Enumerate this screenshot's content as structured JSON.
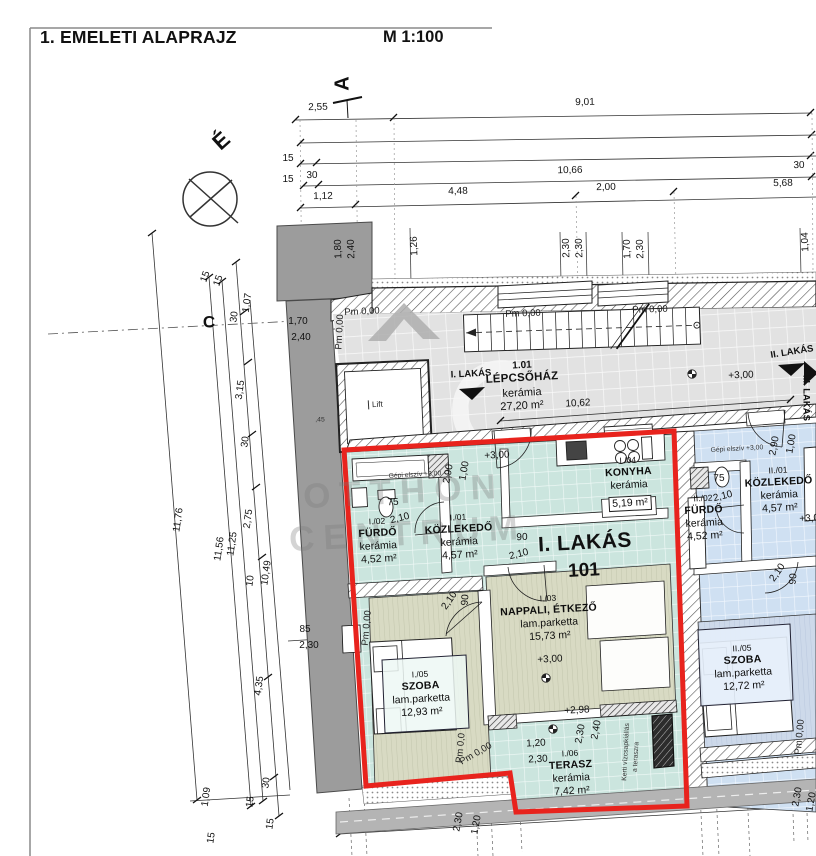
{
  "header": {
    "title": "1. EMELETI ALAPRAJZ",
    "scale": "M 1:100"
  },
  "markers": {
    "north": "É",
    "section_a": "A",
    "apt1": "I. LAKÁS",
    "apt2": "II. LAKÁS",
    "apt3": "III. LAKÁS"
  },
  "stairwell": {
    "id": "1.01",
    "name": "LÉPCSŐHÁZ",
    "floor": "kerámia",
    "area": "27,20 m²",
    "lift": "Lift"
  },
  "watermark": {
    "line1": "OTTHON",
    "line2": "CENTRUM"
  },
  "colors": {
    "accent_red": "#E8231D",
    "apt1_teal": "#CBE5DE",
    "apt2_blue": "#CFE0F2",
    "mass_gray": "#9C9C9C"
  },
  "apartments": [
    {
      "id": "I. LAKÁS",
      "number": "101",
      "rooms": [
        {
          "id": "I./02",
          "name": "FÜRDŐ",
          "floor": "kerámia",
          "area": "4,52 m²",
          "cx": 378,
          "ty": 516
        },
        {
          "id": "I./01",
          "name": "KÖZLEKEDŐ",
          "floor": "kerámia",
          "area": "4,57 m²",
          "cx": 459,
          "ty": 512
        },
        {
          "id": "I./04",
          "name": "KONYHA",
          "floor": "kerámia",
          "area": "5,19 m²",
          "cx": 629,
          "ty": 455,
          "boxed": true
        },
        {
          "id": "I./03",
          "name": "NAPPALI, ÉTKEZŐ",
          "floor": "lam.parketta",
          "area": "15,73 m²",
          "cx": 549,
          "ty": 593
        },
        {
          "id": "I./05",
          "name": "SZOBA",
          "floor": "lam.parketta",
          "area": "12,93 m²",
          "cx": 421,
          "ty": 669
        },
        {
          "id": "I./06",
          "name": "TERASZ",
          "floor": "kerámia",
          "area": "7,42 m²",
          "cx": 571,
          "ty": 748
        }
      ]
    },
    {
      "id": "II. LAKÁS",
      "number": "",
      "rooms": [
        {
          "id": "II./02",
          "name": "FÜRDŐ",
          "floor": "kerámia",
          "area": "4,52 m²",
          "cx": 704,
          "ty": 493
        },
        {
          "id": "II./01",
          "name": "KÖZLEKEDŐ",
          "floor": "kerámia",
          "area": "4,57 m²",
          "cx": 779,
          "ty": 465
        },
        {
          "id": "II./05",
          "name": "SZOBA",
          "floor": "lam.parketta",
          "area": "12,72 m²",
          "cx": 743,
          "ty": 643
        }
      ]
    }
  ],
  "annotations": [
    {
      "t": "2,55",
      "x": 318,
      "y": 108,
      "r": -1
    },
    {
      "t": "9,01",
      "x": 585,
      "y": 103,
      "r": -1
    },
    {
      "t": "15",
      "x": 288,
      "y": 159
    },
    {
      "t": "15",
      "x": 288,
      "y": 180
    },
    {
      "t": "30",
      "x": 312,
      "y": 176,
      "r": -1
    },
    {
      "t": "10,66",
      "x": 570,
      "y": 171,
      "r": -1
    },
    {
      "t": "30",
      "x": 799,
      "y": 166,
      "r": -1
    },
    {
      "t": "1,12",
      "x": 323,
      "y": 197,
      "r": -1
    },
    {
      "t": "4,48",
      "x": 458,
      "y": 192,
      "r": -1
    },
    {
      "t": "2,00",
      "x": 606,
      "y": 188,
      "r": -1
    },
    {
      "t": "5,68",
      "x": 783,
      "y": 184,
      "r": -1
    },
    {
      "t": "1,80",
      "x": 339,
      "y": 249,
      "r": -92
    },
    {
      "t": "2,40",
      "x": 352,
      "y": 249,
      "r": -92
    },
    {
      "t": "1,26",
      "x": 415,
      "y": 246,
      "r": -92
    },
    {
      "t": "2,30",
      "x": 567,
      "y": 248,
      "r": -92
    },
    {
      "t": "2,30",
      "x": 580,
      "y": 248,
      "r": -92
    },
    {
      "t": "1,70",
      "x": 628,
      "y": 249,
      "r": -92
    },
    {
      "t": "2,30",
      "x": 641,
      "y": 249,
      "r": -92
    },
    {
      "t": "1,04",
      "x": 806,
      "y": 242,
      "r": -92
    },
    {
      "t": "15",
      "x": 206,
      "y": 277,
      "r": -70
    },
    {
      "t": "15",
      "x": 219,
      "y": 281,
      "r": -70
    },
    {
      "t": "C",
      "x": 209,
      "y": 322,
      "k": "grid"
    },
    {
      "t": "30",
      "x": 235,
      "y": 317,
      "r": -82
    },
    {
      "t": "1,07",
      "x": 248,
      "y": 303,
      "r": -82
    },
    {
      "t": "1,70",
      "x": 298,
      "y": 322
    },
    {
      "t": "2,40",
      "x": 301,
      "y": 338
    },
    {
      "t": "3,15",
      "x": 241,
      "y": 390,
      "r": -82
    },
    {
      "t": "30",
      "x": 246,
      "y": 442,
      "r": -82
    },
    {
      "t": "2,75",
      "x": 249,
      "y": 519,
      "r": -82
    },
    {
      "t": "11,25",
      "x": 233,
      "y": 544,
      "r": -82
    },
    {
      "t": "11,56",
      "x": 220,
      "y": 549,
      "r": -82
    },
    {
      "t": "11,76",
      "x": 179,
      "y": 520,
      "r": -82
    },
    {
      "t": "10,49",
      "x": 267,
      "y": 573,
      "r": -82
    },
    {
      "t": "10",
      "x": 251,
      "y": 581,
      "r": -82
    },
    {
      "t": "85",
      "x": 305,
      "y": 630
    },
    {
      "t": "2,30",
      "x": 309,
      "y": 646
    },
    {
      "t": "4,35",
      "x": 260,
      "y": 686,
      "r": -82
    },
    {
      "t": "30",
      "x": 267,
      "y": 783,
      "r": -82
    },
    {
      "t": "1,09",
      "x": 207,
      "y": 797,
      "r": -82
    },
    {
      "t": "15",
      "x": 212,
      "y": 838,
      "r": -82
    },
    {
      "t": "15",
      "x": 251,
      "y": 802,
      "r": -82
    },
    {
      "t": "15",
      "x": 271,
      "y": 824,
      "r": -82
    },
    {
      "t": ",45",
      "x": 320,
      "y": 421,
      "k": "tiny"
    },
    {
      "t": "Pm 0,00",
      "x": 362,
      "y": 312,
      "k": "pm",
      "r": -3
    },
    {
      "t": "Pm 0,00",
      "x": 340,
      "y": 332,
      "k": "pm",
      "r": -87
    },
    {
      "t": "Pm 0,00",
      "x": 523,
      "y": 314,
      "k": "pm",
      "r": -2
    },
    {
      "t": "Pm 0,00",
      "x": 650,
      "y": 310,
      "k": "pm",
      "r": -2
    },
    {
      "t": "+3,00",
      "x": 741,
      "y": 376,
      "r": -2
    },
    {
      "t": "10,62",
      "x": 578,
      "y": 404,
      "r": -3
    },
    {
      "t": "+3,00",
      "x": 497,
      "y": 456,
      "r": -3
    },
    {
      "t": "2,90",
      "x": 449,
      "y": 474,
      "r": -80
    },
    {
      "t": "1,00",
      "x": 465,
      "y": 471,
      "r": -80
    },
    {
      "t": "Gépi elszív +3,00",
      "x": 415,
      "y": 476,
      "k": "tiny",
      "r": -3
    },
    {
      "t": "75",
      "x": 393,
      "y": 503,
      "r": -2
    },
    {
      "t": "2,10",
      "x": 400,
      "y": 519,
      "r": -14
    },
    {
      "t": "90",
      "x": 522,
      "y": 538,
      "r": -2
    },
    {
      "t": "2,10",
      "x": 519,
      "y": 555,
      "r": -14
    },
    {
      "t": "2,10",
      "x": 450,
      "y": 601,
      "r": -55
    },
    {
      "t": "90",
      "x": 466,
      "y": 600,
      "r": -85
    },
    {
      "t": "+3,00",
      "x": 550,
      "y": 660,
      "r": -3
    },
    {
      "t": "Pm 0,00",
      "x": 367,
      "y": 628,
      "k": "pm",
      "r": -85
    },
    {
      "t": "+2,98",
      "x": 577,
      "y": 711,
      "r": -3
    },
    {
      "t": "1,20",
      "x": 536,
      "y": 744,
      "r": -3
    },
    {
      "t": "2,30",
      "x": 538,
      "y": 760,
      "r": -3
    },
    {
      "t": "2,30",
      "x": 581,
      "y": 734,
      "r": -80
    },
    {
      "t": "2,40",
      "x": 597,
      "y": 730,
      "r": -80
    },
    {
      "t": "Kerti vízcsapkiállás",
      "x": 627,
      "y": 752,
      "k": "tiny",
      "r": -87
    },
    {
      "t": "a teraszra",
      "x": 637,
      "y": 757,
      "k": "tiny",
      "r": -87
    },
    {
      "t": "Pm 0,00",
      "x": 476,
      "y": 754,
      "k": "pm",
      "r": -30
    },
    {
      "t": "Pm 0,0",
      "x": 461,
      "y": 748,
      "k": "pm",
      "r": -85
    },
    {
      "t": "2,30",
      "x": 459,
      "y": 822,
      "r": -80
    },
    {
      "t": "1,20",
      "x": 477,
      "y": 825,
      "r": -80
    },
    {
      "t": "75",
      "x": 719,
      "y": 479,
      "r": -2
    },
    {
      "t": "2,10",
      "x": 723,
      "y": 497,
      "r": -14
    },
    {
      "t": "2,90",
      "x": 775,
      "y": 446,
      "r": -80
    },
    {
      "t": "1,00",
      "x": 792,
      "y": 444,
      "r": -80
    },
    {
      "t": "Gépi elszív +3,00",
      "x": 737,
      "y": 450,
      "k": "tiny",
      "r": -3
    },
    {
      "t": "+3,00",
      "x": 812,
      "y": 519,
      "r": -3
    },
    {
      "t": "2,10",
      "x": 778,
      "y": 573,
      "r": -55
    },
    {
      "t": "90",
      "x": 794,
      "y": 579,
      "r": -85
    },
    {
      "t": "Pm 0,00",
      "x": 800,
      "y": 737,
      "k": "pm",
      "r": -85
    },
    {
      "t": "2,30",
      "x": 798,
      "y": 797,
      "r": -80
    },
    {
      "t": "1,20",
      "x": 812,
      "y": 802,
      "r": -80
    }
  ]
}
